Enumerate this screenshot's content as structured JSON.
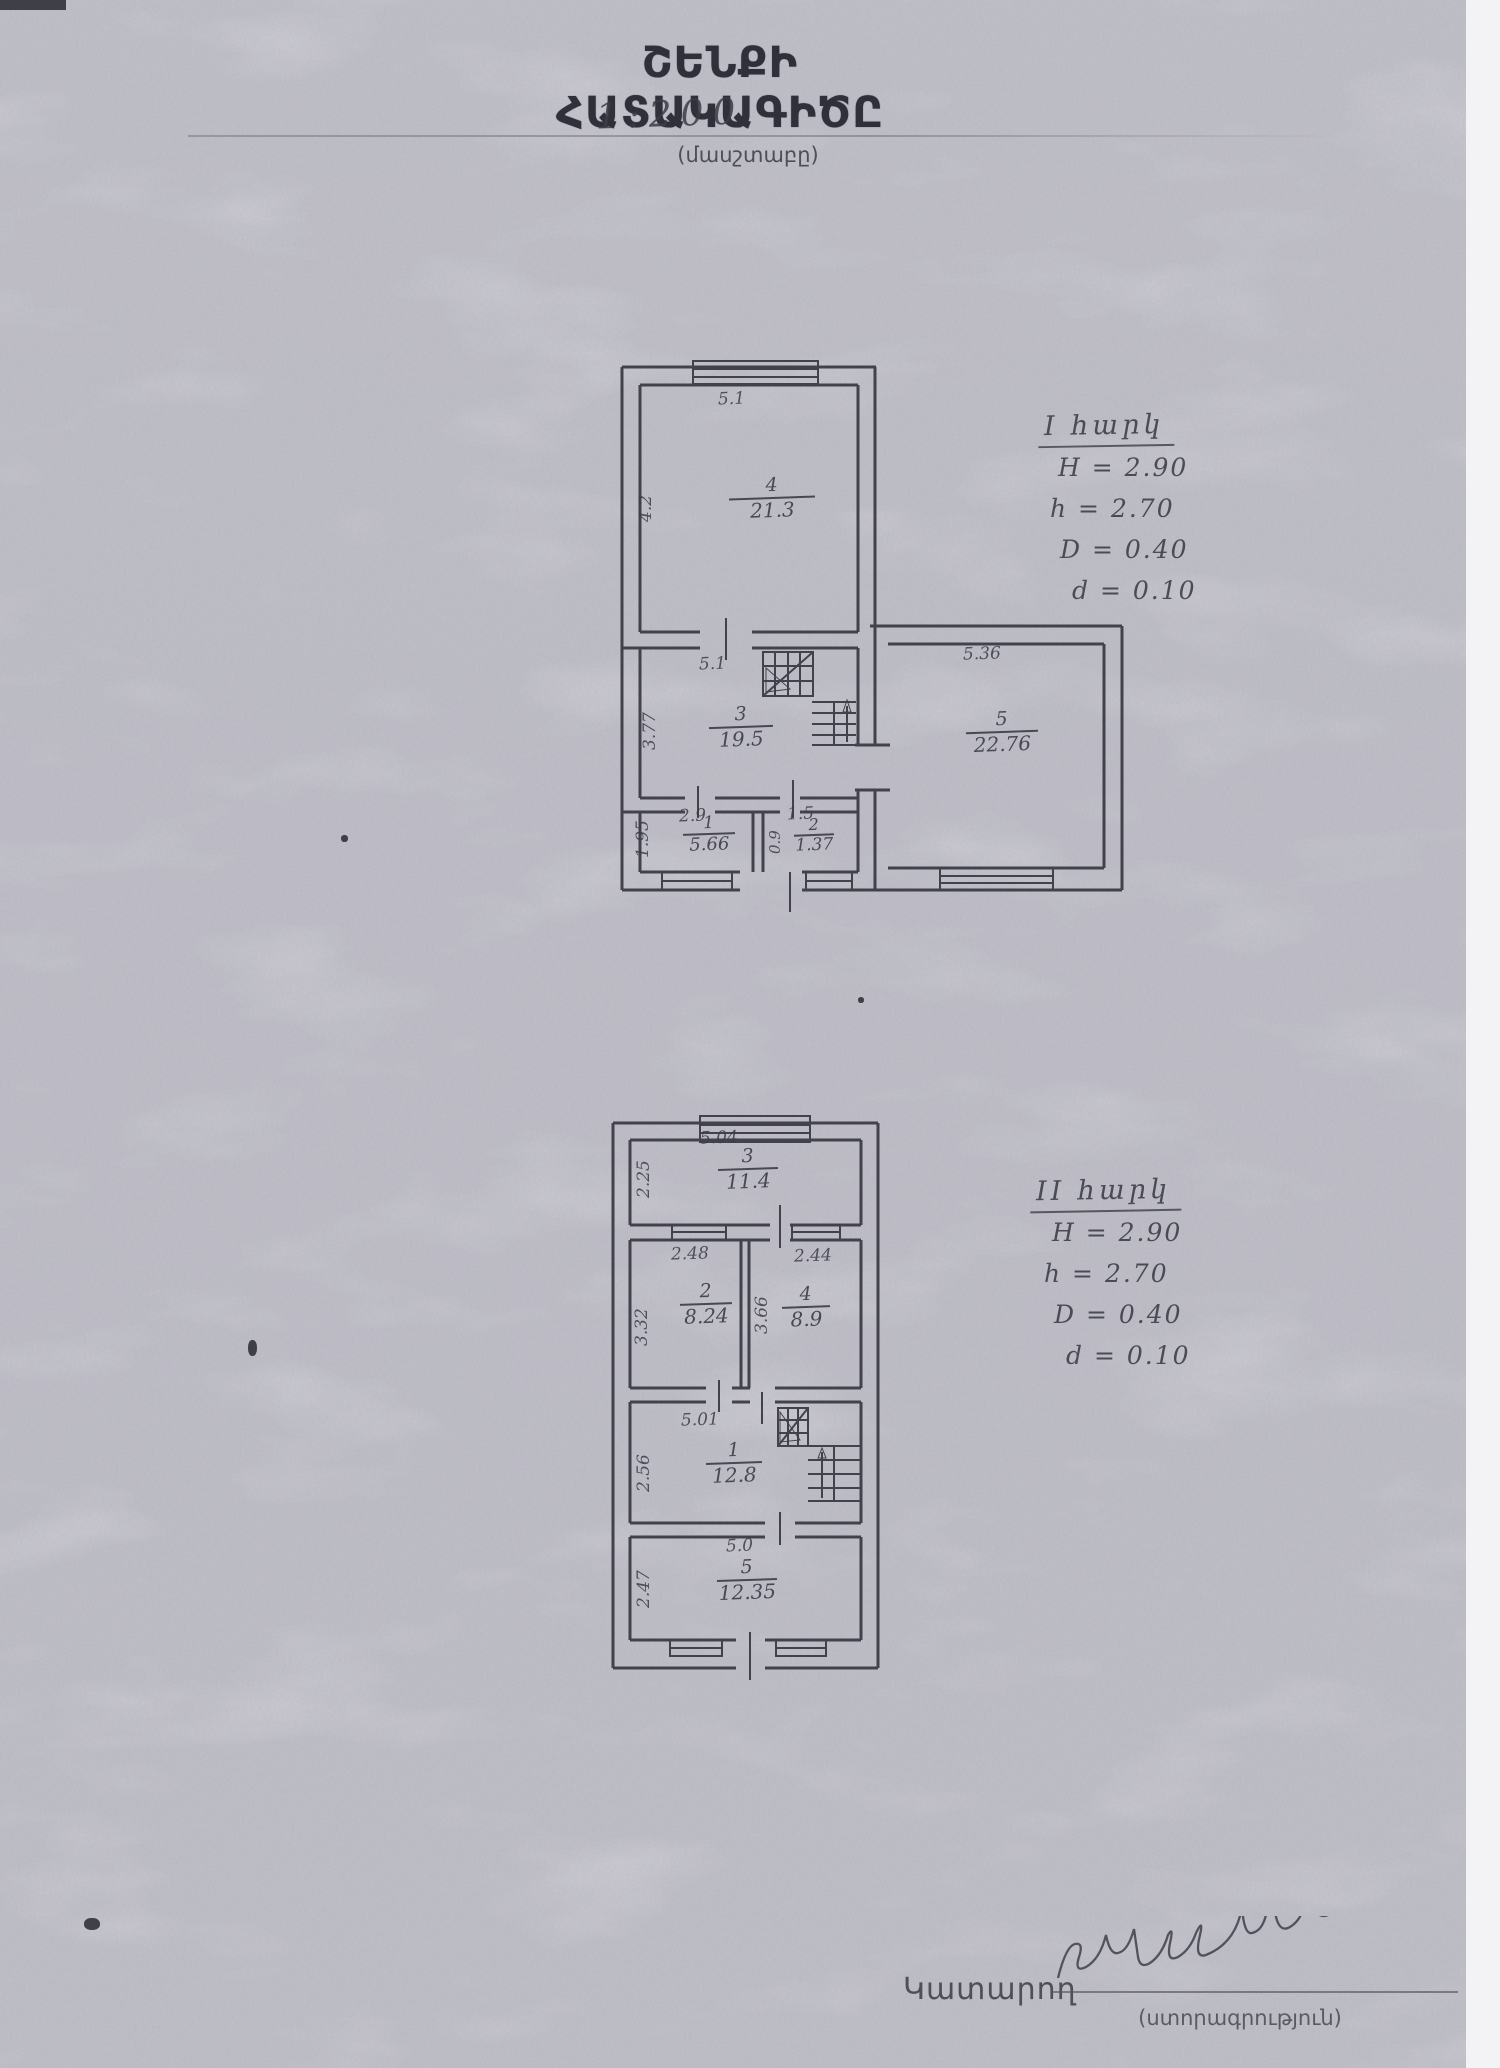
{
  "page": {
    "title": "ՇԵՆՔԻ ՀԱՏԱԿԱԳԻԾԸ",
    "scale": "1:200",
    "scale_caption": "(մասշտաբը)",
    "executor_label": "Կատարող",
    "signature_caption": "(ստորագրություն)"
  },
  "floor1": {
    "heading": "I հարկ",
    "params": [
      "H = 2.90",
      "h = 2.70",
      "D = 0.40",
      "d = 0.10"
    ],
    "rooms": {
      "r4": {
        "number": "4",
        "area": "21.3",
        "width": "5.1",
        "depth": "4.2"
      },
      "r3": {
        "number": "3",
        "area": "19.5",
        "width": "5.1",
        "depth": "3.77"
      },
      "r1": {
        "number": "1",
        "area": "5.66",
        "width": "2.9",
        "depth": "1.95"
      },
      "r2": {
        "number": "2",
        "area": "1.37",
        "width": "1.5",
        "depth": "0.9"
      },
      "r5": {
        "number": "5",
        "area": "22.76",
        "width": "5.36"
      }
    }
  },
  "floor2": {
    "heading": "II հարկ",
    "params": [
      "H = 2.90",
      "h = 2.70",
      "D = 0.40",
      "d = 0.10"
    ],
    "rooms": {
      "r3": {
        "number": "3",
        "area": "11.4",
        "width": "5.04",
        "depth": "2.25"
      },
      "r2": {
        "number": "2",
        "area": "8.24",
        "width": "2.48",
        "depth": "3.32"
      },
      "r4": {
        "number": "4",
        "area": "8.9",
        "width": "2.44",
        "depth": "3.66"
      },
      "r1": {
        "number": "1",
        "area": "12.8",
        "width": "5.01",
        "depth": "2.56"
      },
      "r5": {
        "number": "5",
        "area": "12.35",
        "width": "5.0",
        "depth": "2.47"
      }
    }
  }
}
